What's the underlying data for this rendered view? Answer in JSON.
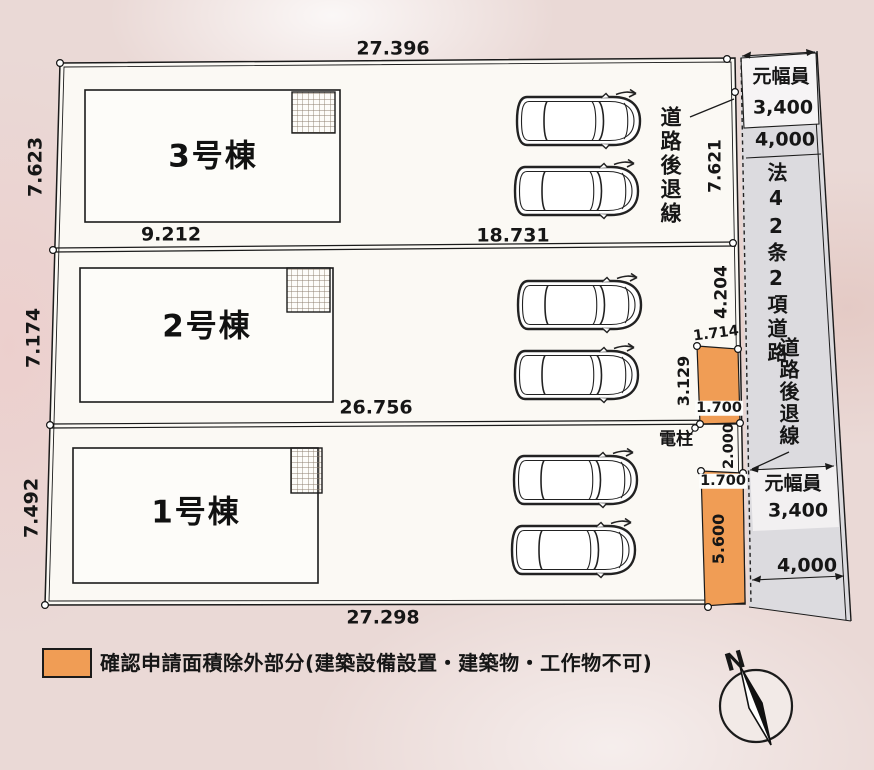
{
  "colors": {
    "orange": "#f09d55",
    "road_gray": "#dcdbdf",
    "background": "#ead9d6",
    "site_fill": "#fbf9f4",
    "ink": "#1b1b1b"
  },
  "buildings": [
    {
      "label": "3号棟"
    },
    {
      "label": "2号棟"
    },
    {
      "label": "1号棟"
    }
  ],
  "dims": {
    "site_top": "27.396",
    "b3_left": "7.623",
    "b3_w1": "9.212",
    "b3_w2": "18.731",
    "b2_left": "7.174",
    "b2_bottom": "26.756",
    "b1_left": "7.492",
    "site_bottom": "27.298",
    "right_top": "7.621",
    "right_mid": "4.204",
    "o1_top": "1.714",
    "o1_left": "3.129",
    "o1_bottom": "1.700",
    "gap": "2.000",
    "o2_top": "1.700",
    "o2_left": "5.600"
  },
  "road": {
    "setback1": "道路後退線",
    "setback2": "道路後退線",
    "orig_label_top": "元幅員",
    "orig_val_top": "3,400",
    "width_top": "4,000",
    "name": "法42条2項道路",
    "orig_label_bot": "元幅員",
    "orig_val_bot": "3,400",
    "width_bot": "4,000"
  },
  "pole": {
    "label": "電柱"
  },
  "legend": {
    "text": "確認申請面積除外部分(建築設備設置・建築物・工作物不可)"
  },
  "compass": {
    "label": "N"
  }
}
